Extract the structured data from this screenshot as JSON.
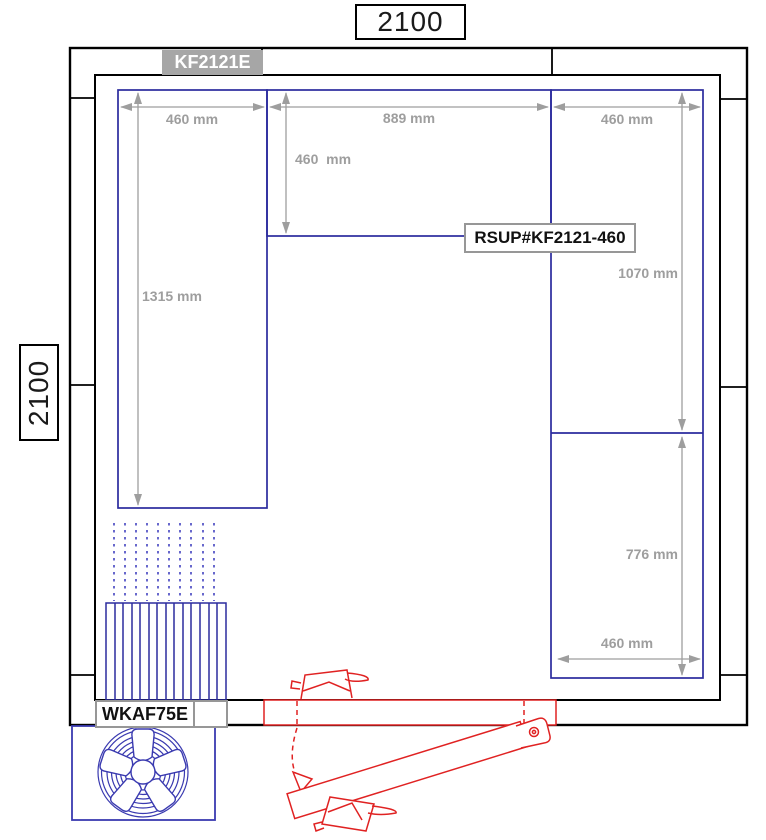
{
  "labels": {
    "overall_width": "2100",
    "overall_height": "2100",
    "model": "KF2121E",
    "shelf_part": "RSUP#KF2121-460",
    "evaporator": "WKAF75E"
  },
  "dimensions": {
    "top_left_shelf_width": "460 mm",
    "top_opening_width": "889 mm",
    "top_right_shelf_width": "460 mm",
    "top_shelf_depth": "460  mm",
    "left_shelf_length": "1315 mm",
    "right_shelf_upper_length": "1070 mm",
    "right_shelf_lower_length": "776 mm",
    "bottom_right_shelf_width": "460 mm"
  },
  "colors": {
    "wall": "#000000",
    "shelving": "#2b2b9e",
    "fan_unit": "#3a3ab0",
    "airflow": "#4242c0",
    "dimension": "#9e9e9e",
    "door": "#e02222",
    "model_badge_bg": "#a6a6a6",
    "label_border": "#979797"
  }
}
